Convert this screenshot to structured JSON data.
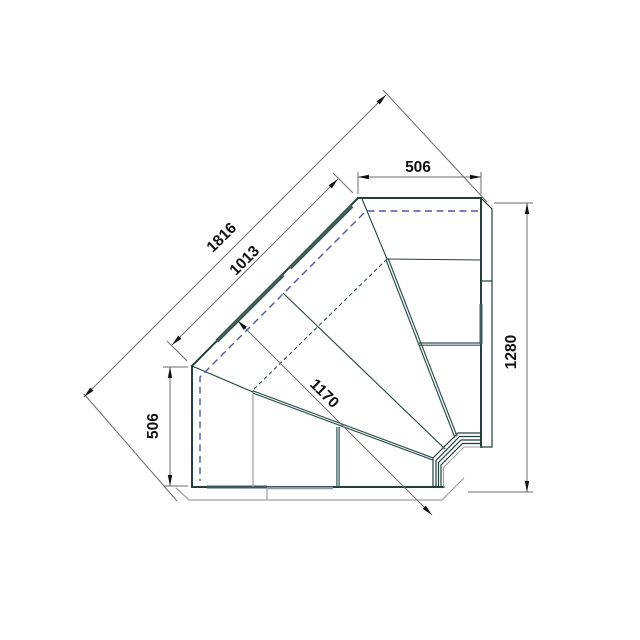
{
  "title": "Corner display counter — plan view technical drawing",
  "drawing": {
    "dims": {
      "top_width": "506",
      "overall_diagonal": "1816",
      "front_diagonal": "1013",
      "left_depth": "506",
      "corner_depth": "1170",
      "right_depth": "1280"
    },
    "colors": {
      "line_dark": "#233f3c",
      "line_teal": "#3d5a57",
      "line_light": "#9aa0a0",
      "dash_blue": "#4d57a9",
      "dim_gray": "#6b6b6b",
      "text": "#111111",
      "background": "#ffffff"
    }
  }
}
